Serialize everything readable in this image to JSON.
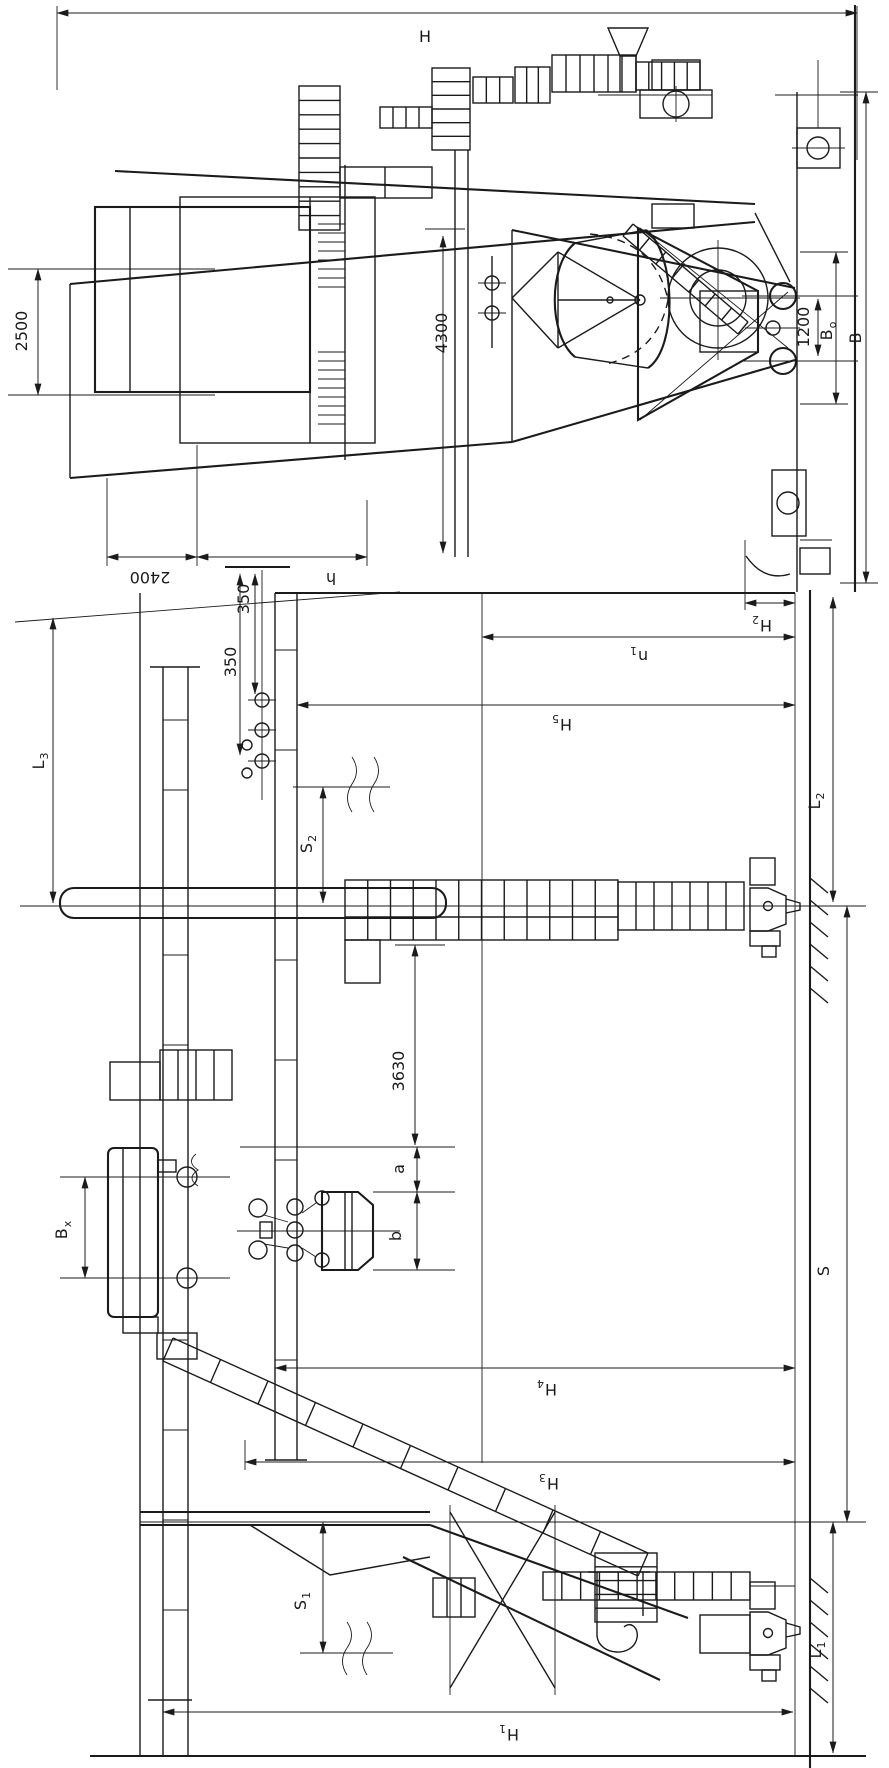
{
  "drawing": {
    "subject": "Portal grab crane - general arrangement drawing with end elevation and side elevation views (rotated 90 degrees)",
    "view_names": [
      "end-elevation",
      "side-elevation"
    ],
    "line_color": "#1b1b1b",
    "background_color": "#ffffff"
  },
  "dimension_labels": [
    {
      "text": "H",
      "sub": "",
      "x": 425,
      "y": 42,
      "rot": 0
    },
    {
      "text": "2500",
      "sub": "",
      "x": 27,
      "y": 331,
      "rot": -90
    },
    {
      "text": "2400",
      "sub": "",
      "x": 150,
      "y": 572,
      "rot": 180
    },
    {
      "text": "h",
      "sub": "",
      "x": 331,
      "y": 573,
      "rot": 180
    },
    {
      "text": "350",
      "sub": "",
      "x": 249,
      "y": 599,
      "rot": -90
    },
    {
      "text": "350",
      "sub": "",
      "x": 236,
      "y": 662,
      "rot": -90
    },
    {
      "text": "4300",
      "sub": "",
      "x": 447,
      "y": 333,
      "rot": -90
    },
    {
      "text": "1200",
      "sub": "",
      "x": 809,
      "y": 327,
      "rot": -90
    },
    {
      "text": "B",
      "sub": "o",
      "x": 832,
      "y": 331,
      "rot": -90
    },
    {
      "text": "B",
      "sub": "",
      "x": 861,
      "y": 338,
      "rot": -90
    },
    {
      "text": "H",
      "sub": "2",
      "x": 762,
      "y": 620,
      "rot": 180
    },
    {
      "text": "n",
      "sub": "1",
      "x": 639,
      "y": 651,
      "rot": 180
    },
    {
      "text": "H",
      "sub": "5",
      "x": 562,
      "y": 719,
      "rot": 180
    },
    {
      "text": "L",
      "sub": "3",
      "x": 44,
      "y": 761,
      "rot": -90
    },
    {
      "text": "S",
      "sub": "2",
      "x": 312,
      "y": 844,
      "rot": -90
    },
    {
      "text": "L",
      "sub": "2",
      "x": 820,
      "y": 801,
      "rot": -90
    },
    {
      "text": "3630",
      "sub": "",
      "x": 404,
      "y": 1071,
      "rot": -90
    },
    {
      "text": "B",
      "sub": "x",
      "x": 67,
      "y": 1230,
      "rot": -90
    },
    {
      "text": "a",
      "sub": "",
      "x": 404,
      "y": 1169,
      "rot": -90
    },
    {
      "text": "b",
      "sub": "",
      "x": 401,
      "y": 1236,
      "rot": -90
    },
    {
      "text": "H",
      "sub": "4",
      "x": 547,
      "y": 1384,
      "rot": 180
    },
    {
      "text": "H",
      "sub": "3",
      "x": 549,
      "y": 1478,
      "rot": 180
    },
    {
      "text": "S",
      "sub": "",
      "x": 829,
      "y": 1271,
      "rot": -90
    },
    {
      "text": "S",
      "sub": "1",
      "x": 306,
      "y": 1601,
      "rot": -90
    },
    {
      "text": "L",
      "sub": "1",
      "x": 821,
      "y": 1650,
      "rot": -90
    },
    {
      "text": "H",
      "sub": "1",
      "x": 509,
      "y": 1729,
      "rot": 180
    }
  ]
}
